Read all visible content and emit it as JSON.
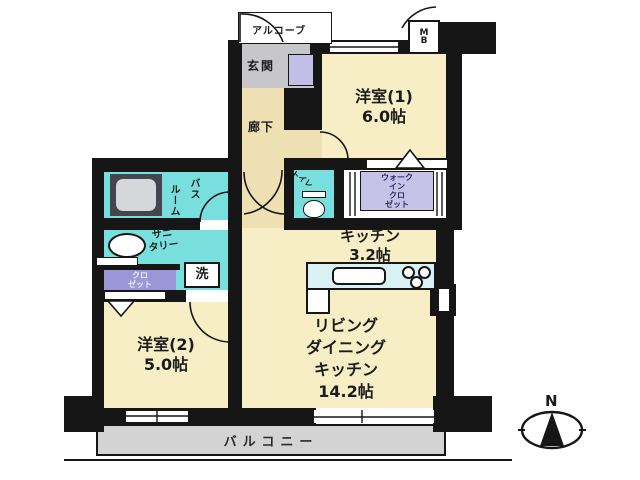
{
  "colors": {
    "wall": "#161616",
    "ink": "#1c1c1c",
    "room": "#f7eec6",
    "hall": "#efe0b4",
    "wet": "#79dede",
    "counter": "#d9f1f5",
    "wic": "#c7c3e8",
    "closet": "#9a96d8",
    "shoebox": "#c2bee6",
    "entry": "#c7c7cb",
    "balcony": "#d3d3d3",
    "tub_outer": "#45454e",
    "tub_inner": "#d6d7da"
  },
  "plan": {
    "alcove": "アルコーブ",
    "entrance": "玄関",
    "hallway": "廊下",
    "meter_box": {
      "l1": "M",
      "l2": "B"
    },
    "room1": {
      "name": "洋室(1)",
      "size": "6.0帖"
    },
    "wic": {
      "l1": "ウォーク",
      "l2": "イン",
      "l3": "クロ",
      "l4": "ゼット"
    },
    "toilet": "トイレ",
    "bath": {
      "l1": "バス",
      "l2": "ルーム"
    },
    "sanitary": {
      "l1": "サニ",
      "l2": "タリー"
    },
    "washer": "洗",
    "closet": {
      "l1": "クロ",
      "l2": "ゼット"
    },
    "room2": {
      "name": "洋室(2)",
      "size": "5.0帖"
    },
    "kitchen": {
      "name": "キッチン",
      "size": "3.2帖"
    },
    "ldk": {
      "l1": "リビング",
      "l2": "ダイニング",
      "l3": "キッチン",
      "l4": "14.2帖"
    },
    "balcony": "バルコニー",
    "compass": "N"
  }
}
